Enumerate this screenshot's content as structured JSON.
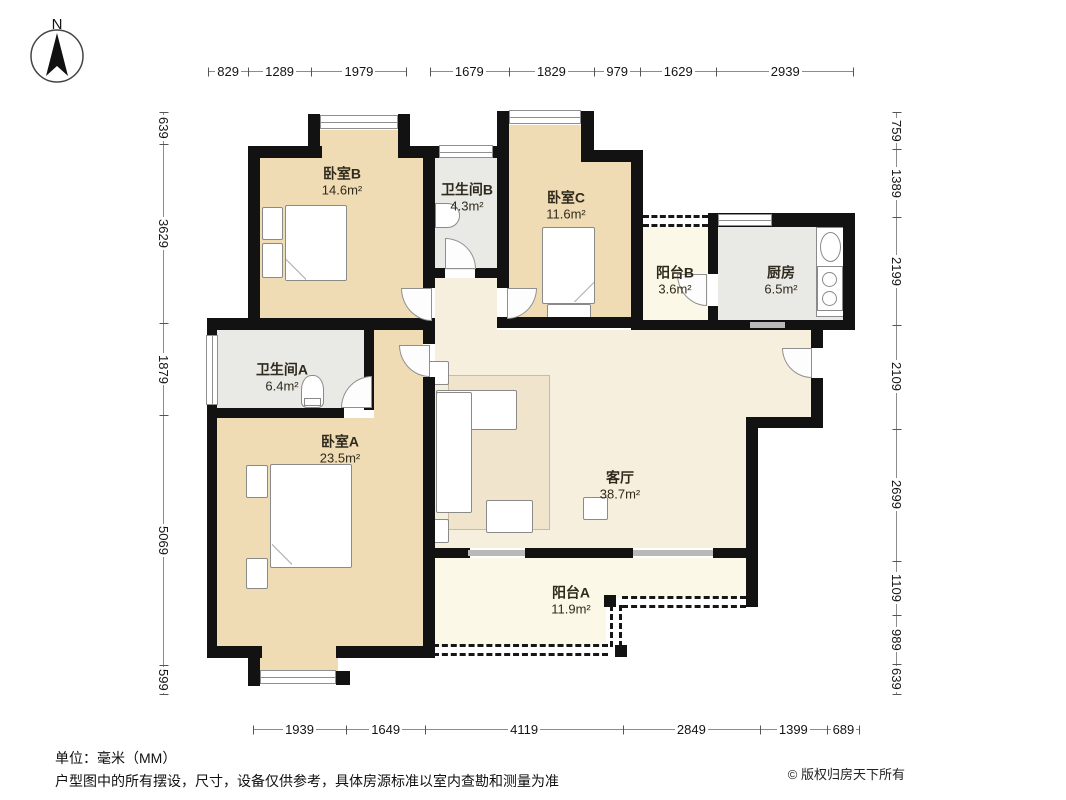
{
  "compass": {
    "north_label": "N"
  },
  "rooms": {
    "bedroom_b": {
      "name": "卧室B",
      "area": "14.6m²"
    },
    "bathroom_b": {
      "name": "卫生间B",
      "area": "4.3m²"
    },
    "bedroom_c": {
      "name": "卧室C",
      "area": "11.6m²"
    },
    "balcony_b": {
      "name": "阳台B",
      "area": "3.6m²"
    },
    "kitchen": {
      "name": "厨房",
      "area": "6.5m²"
    },
    "bathroom_a": {
      "name": "卫生间A",
      "area": "6.4m²"
    },
    "bedroom_a": {
      "name": "卧室A",
      "area": "23.5m²"
    },
    "living_room": {
      "name": "客厅",
      "area": "38.7m²"
    },
    "balcony_a": {
      "name": "阳台A",
      "area": "11.9m²"
    }
  },
  "dimensions": {
    "unit": "mm",
    "top_left": {
      "values": [
        829,
        1289,
        1979
      ]
    },
    "top_right": {
      "values": [
        1679,
        1829,
        979,
        1629,
        2939
      ]
    },
    "left": {
      "values": [
        639,
        3629,
        1879,
        5069,
        599
      ]
    },
    "right": {
      "values": [
        759,
        1389,
        2199,
        2109,
        2699,
        1109,
        989,
        639
      ]
    },
    "bottom": {
      "values": [
        1939,
        1649,
        4119,
        2849,
        1399,
        689
      ]
    }
  },
  "footer": {
    "unit_note": "单位：毫米（MM）",
    "disclaimer": "户型图中的所有摆设，尺寸，设备仅供参考，具体房源标准以室内查勘和测量为准",
    "copyright": "© 版权归房天下所有"
  },
  "colors": {
    "bedroom_fill": "#f0dcb4",
    "wet_room_fill": "#e9e9e6",
    "living_fill": "#f7efde",
    "balcony_fill": "#fcf8e8",
    "wall": "#121212"
  }
}
